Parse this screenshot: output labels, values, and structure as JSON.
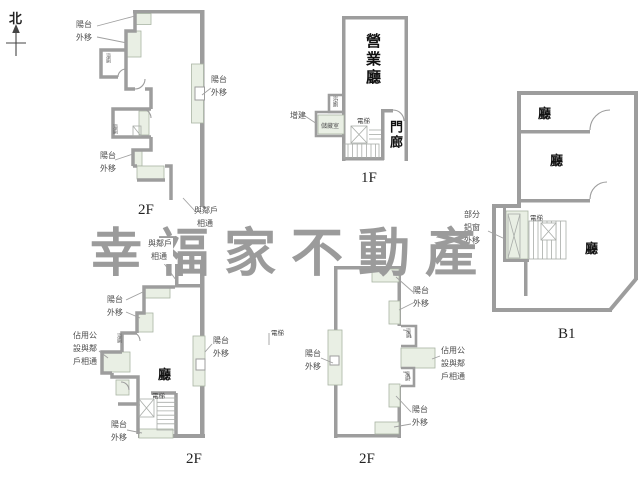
{
  "compass": {
    "north": "北"
  },
  "watermark": {
    "text": "幸福家不動產",
    "color": "#9b9b9b"
  },
  "strings": {
    "balcony_line1": "陽台",
    "balcony_line2": "外移",
    "neighbor_line1": "與鄰戶",
    "neighbor_line2": "相通",
    "occupy_line1": "佔用公",
    "occupy_line2": "設與鄰",
    "occupy_line3": "戶相通",
    "partial_line1": "部分",
    "partial_line2": "鋁窗",
    "partial_line3": "外移",
    "addition": "增建",
    "elevator": "電梯",
    "bath": "浴廁",
    "storage": "儲藏室",
    "hall": "廳",
    "business_hall": "營業廳",
    "porch": "門廊"
  },
  "floors": {
    "plan_a": "2F",
    "plan_b": "1F",
    "plan_c": "B1",
    "plan_d": "2F",
    "plan_e": "2F"
  },
  "colors": {
    "wall": "#9d9d9d",
    "balcony_fill": "#e9efe4",
    "label": "#4c4c4c",
    "room_label": "#111111",
    "leader": "#a0a0a0"
  }
}
